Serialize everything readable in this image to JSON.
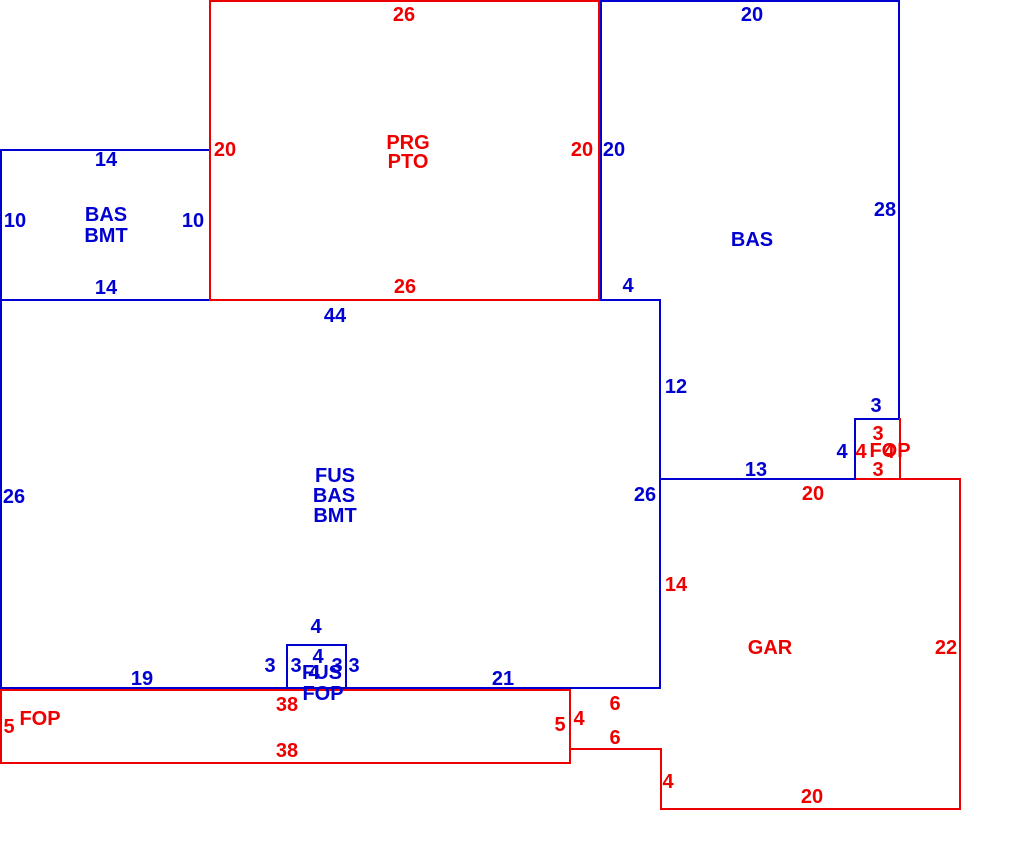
{
  "sketch": {
    "title": "Appraisal floor plan sketch",
    "canvas": {
      "width": 1010,
      "height": 868,
      "background": "#ffffff"
    },
    "colors": {
      "blue": "#0000d0",
      "red": "#ee0000"
    },
    "areas": {
      "basement_left": [
        "BAS",
        "BMT"
      ],
      "patio": [
        "PRG",
        "PTO"
      ],
      "basement_right": [
        "BAS"
      ],
      "main": [
        "FUS",
        "BAS",
        "BMT"
      ],
      "bump": [
        "FUS",
        "FOP"
      ],
      "porch_strip": [
        "FOP"
      ],
      "garage": [
        "GAR"
      ],
      "stoop": [
        "FOP"
      ]
    },
    "labels": [
      {
        "name": "dim-bmt-top-14",
        "text": "14",
        "x": 106,
        "y": 160,
        "color": "blue"
      },
      {
        "name": "dim-bmt-left-10",
        "text": "10",
        "x": 15,
        "y": 221,
        "color": "blue"
      },
      {
        "name": "dim-bmt-right-10",
        "text": "10",
        "x": 193,
        "y": 221,
        "color": "blue"
      },
      {
        "name": "dim-bmt-bottom-14",
        "text": "14",
        "x": 106,
        "y": 288,
        "color": "blue"
      },
      {
        "name": "area-bmt-line1",
        "text": "BAS",
        "x": 106,
        "y": 215,
        "color": "blue"
      },
      {
        "name": "area-bmt-line2",
        "text": "BMT",
        "x": 106,
        "y": 236,
        "color": "blue"
      },
      {
        "name": "dim-prg-top-26",
        "text": "26",
        "x": 404,
        "y": 15,
        "color": "red"
      },
      {
        "name": "dim-prg-left-20",
        "text": "20",
        "x": 225,
        "y": 150,
        "color": "red"
      },
      {
        "name": "area-prg-line1",
        "text": "PRG",
        "x": 408,
        "y": 143,
        "color": "red"
      },
      {
        "name": "area-prg-line2",
        "text": "PTO",
        "x": 408,
        "y": 162,
        "color": "red"
      },
      {
        "name": "dim-prg-right-20",
        "text": "20",
        "x": 582,
        "y": 150,
        "color": "red"
      },
      {
        "name": "dim-prg-bottom-26",
        "text": "26",
        "x": 405,
        "y": 287,
        "color": "red"
      },
      {
        "name": "dim-bas-top-20",
        "text": "20",
        "x": 752,
        "y": 15,
        "color": "blue"
      },
      {
        "name": "dim-bas-left-20",
        "text": "20",
        "x": 614,
        "y": 150,
        "color": "blue"
      },
      {
        "name": "dim-bas-right-28",
        "text": "28",
        "x": 885,
        "y": 210,
        "color": "blue"
      },
      {
        "name": "area-bas-right",
        "text": "BAS",
        "x": 752,
        "y": 240,
        "color": "blue"
      },
      {
        "name": "dim-bas-step-4",
        "text": "4",
        "x": 628,
        "y": 286,
        "color": "blue"
      },
      {
        "name": "dim-bas-side-12",
        "text": "12",
        "x": 676,
        "y": 387,
        "color": "blue"
      },
      {
        "name": "dim-bas-bottom-13",
        "text": "13",
        "x": 756,
        "y": 470,
        "color": "blue"
      },
      {
        "name": "dim-bas-notch-3",
        "text": "3",
        "x": 876,
        "y": 406,
        "color": "blue"
      },
      {
        "name": "dim-bas-notch-4",
        "text": "4",
        "x": 842,
        "y": 452,
        "color": "blue"
      },
      {
        "name": "dim-stoop-top-3",
        "text": "3",
        "x": 878,
        "y": 434,
        "color": "red"
      },
      {
        "name": "dim-stoop-left-4",
        "text": "4",
        "x": 861,
        "y": 452,
        "color": "red"
      },
      {
        "name": "area-stoop-fop",
        "text": "FOP",
        "x": 890,
        "y": 451,
        "color": "red"
      },
      {
        "name": "dim-stoop-right-4",
        "text": "4",
        "x": 889,
        "y": 452,
        "color": "red"
      },
      {
        "name": "dim-stoop-bottom-3",
        "text": "3",
        "x": 878,
        "y": 470,
        "color": "red"
      },
      {
        "name": "dim-fus-top-44",
        "text": "44",
        "x": 335,
        "y": 316,
        "color": "blue"
      },
      {
        "name": "dim-fus-left-26",
        "text": "26",
        "x": 14,
        "y": 497,
        "color": "blue"
      },
      {
        "name": "dim-fus-right-26",
        "text": "26",
        "x": 645,
        "y": 495,
        "color": "blue"
      },
      {
        "name": "area-fus-line1",
        "text": "FUS",
        "x": 335,
        "y": 476,
        "color": "blue"
      },
      {
        "name": "area-fus-line2",
        "text": "BAS",
        "x": 334,
        "y": 496,
        "color": "blue"
      },
      {
        "name": "area-fus-line3",
        "text": "BMT",
        "x": 335,
        "y": 516,
        "color": "blue"
      },
      {
        "name": "dim-fus-bottom-19",
        "text": "19",
        "x": 142,
        "y": 679,
        "color": "blue"
      },
      {
        "name": "dim-fus-bottom-21",
        "text": "21",
        "x": 503,
        "y": 679,
        "color": "blue"
      },
      {
        "name": "dim-bump-top-out-4",
        "text": "4",
        "x": 316,
        "y": 627,
        "color": "blue"
      },
      {
        "name": "dim-bump-top-in-4",
        "text": "4",
        "x": 318,
        "y": 657,
        "color": "blue"
      },
      {
        "name": "dim-bump-left-out-3",
        "text": "3",
        "x": 270,
        "y": 666,
        "color": "blue"
      },
      {
        "name": "dim-bump-left-in-3",
        "text": "3",
        "x": 296,
        "y": 666,
        "color": "blue"
      },
      {
        "name": "dim-bump-right-in-3",
        "text": "3",
        "x": 337,
        "y": 666,
        "color": "blue"
      },
      {
        "name": "dim-bump-right-out-3",
        "text": "3",
        "x": 354,
        "y": 666,
        "color": "blue"
      },
      {
        "name": "dim-bump-bottom-4",
        "text": "4",
        "x": 314,
        "y": 673,
        "color": "blue"
      },
      {
        "name": "area-bump-line1",
        "text": "FUS",
        "x": 322,
        "y": 673,
        "color": "blue"
      },
      {
        "name": "area-bump-line2",
        "text": "FOP",
        "x": 323,
        "y": 694,
        "color": "blue"
      },
      {
        "name": "dim-gar-top-20",
        "text": "20",
        "x": 813,
        "y": 494,
        "color": "red"
      },
      {
        "name": "dim-gar-left-14",
        "text": "14",
        "x": 676,
        "y": 585,
        "color": "red"
      },
      {
        "name": "area-gar",
        "text": "GAR",
        "x": 770,
        "y": 648,
        "color": "red"
      },
      {
        "name": "dim-gar-right-22",
        "text": "22",
        "x": 946,
        "y": 648,
        "color": "red"
      },
      {
        "name": "dim-gar-bottom-20",
        "text": "20",
        "x": 812,
        "y": 797,
        "color": "red"
      },
      {
        "name": "dim-gar-step-4",
        "text": "4",
        "x": 668,
        "y": 782,
        "color": "red"
      },
      {
        "name": "dim-gar-notch-top-6",
        "text": "6",
        "x": 615,
        "y": 704,
        "color": "red"
      },
      {
        "name": "dim-gar-notch-bot-6",
        "text": "6",
        "x": 615,
        "y": 738,
        "color": "red"
      },
      {
        "name": "dim-gar-notch-side-4",
        "text": "4",
        "x": 579,
        "y": 719,
        "color": "red"
      },
      {
        "name": "area-fop-strip",
        "text": "FOP",
        "x": 40,
        "y": 719,
        "color": "red"
      },
      {
        "name": "dim-fop-left-5",
        "text": "5",
        "x": 9,
        "y": 727,
        "color": "red"
      },
      {
        "name": "dim-fop-top-38",
        "text": "38",
        "x": 287,
        "y": 705,
        "color": "red"
      },
      {
        "name": "dim-fop-bottom-38",
        "text": "38",
        "x": 287,
        "y": 751,
        "color": "red"
      },
      {
        "name": "dim-fop-right-5",
        "text": "5",
        "x": 560,
        "y": 725,
        "color": "red"
      }
    ],
    "lines": [
      {
        "name": "bas-top-edge",
        "x": 600,
        "y": 0,
        "w": 300,
        "h": 2,
        "color": "blue"
      },
      {
        "name": "bas-right-edge",
        "x": 898,
        "y": 0,
        "w": 2,
        "h": 420,
        "color": "blue"
      },
      {
        "name": "bas-notch-top-edge",
        "x": 854,
        "y": 418,
        "w": 46,
        "h": 2,
        "color": "blue"
      },
      {
        "name": "bas-notch-side-edge",
        "x": 854,
        "y": 418,
        "w": 2,
        "h": 62,
        "color": "blue"
      },
      {
        "name": "bas-bottom-13-edge",
        "x": 659,
        "y": 478,
        "w": 197,
        "h": 2,
        "color": "blue"
      },
      {
        "name": "fus-right-edge",
        "x": 659,
        "y": 299,
        "w": 2,
        "h": 390,
        "color": "blue"
      },
      {
        "name": "bas-left-edge",
        "x": 600,
        "y": 0,
        "w": 2,
        "h": 301,
        "color": "blue"
      },
      {
        "name": "fus-top-edge",
        "x": 0,
        "y": 299,
        "w": 661,
        "h": 2,
        "color": "blue"
      },
      {
        "name": "west-edge",
        "x": 0,
        "y": 149,
        "w": 2,
        "h": 540,
        "color": "blue"
      },
      {
        "name": "bmt-top-edge",
        "x": 0,
        "y": 149,
        "w": 211,
        "h": 2,
        "color": "blue"
      },
      {
        "name": "fus-bottom-edge",
        "x": 0,
        "y": 687,
        "w": 661,
        "h": 2,
        "color": "blue"
      },
      {
        "name": "bump-left-edge",
        "x": 286,
        "y": 644,
        "w": 2,
        "h": 45,
        "color": "blue"
      },
      {
        "name": "bump-top-edge",
        "x": 286,
        "y": 644,
        "w": 61,
        "h": 2,
        "color": "blue"
      },
      {
        "name": "bump-right-edge",
        "x": 345,
        "y": 644,
        "w": 2,
        "h": 45,
        "color": "blue"
      },
      {
        "name": "prg-left-edge",
        "x": 209,
        "y": 0,
        "w": 2,
        "h": 301,
        "color": "red"
      },
      {
        "name": "prg-top-edge",
        "x": 209,
        "y": 0,
        "w": 390,
        "h": 2,
        "color": "red"
      },
      {
        "name": "prg-right-edge",
        "x": 598,
        "y": 0,
        "w": 2,
        "h": 301,
        "color": "red"
      },
      {
        "name": "prg-bottom-edge",
        "x": 209,
        "y": 299,
        "w": 390,
        "h": 2,
        "color": "red"
      },
      {
        "name": "fop-strip-top-edge",
        "x": 0,
        "y": 689,
        "w": 571,
        "h": 2,
        "color": "red"
      },
      {
        "name": "fop-strip-left-edge",
        "x": 0,
        "y": 689,
        "w": 2,
        "h": 75,
        "color": "red"
      },
      {
        "name": "fop-strip-bottom-edge",
        "x": 0,
        "y": 762,
        "w": 571,
        "h": 2,
        "color": "red"
      },
      {
        "name": "fop-strip-right-edge",
        "x": 569,
        "y": 689,
        "w": 2,
        "h": 75,
        "color": "red"
      },
      {
        "name": "gar-notch-h-edge",
        "x": 569,
        "y": 748,
        "w": 93,
        "h": 2,
        "color": "red"
      },
      {
        "name": "gar-left-lower-edge",
        "x": 660,
        "y": 748,
        "w": 2,
        "h": 62,
        "color": "red"
      },
      {
        "name": "gar-bottom-edge",
        "x": 660,
        "y": 808,
        "w": 301,
        "h": 2,
        "color": "red"
      },
      {
        "name": "gar-right-edge",
        "x": 959,
        "y": 478,
        "w": 2,
        "h": 332,
        "color": "red"
      },
      {
        "name": "gar-top-edge",
        "x": 856,
        "y": 478,
        "w": 105,
        "h": 2,
        "color": "red"
      },
      {
        "name": "stoop-right-edge",
        "x": 899,
        "y": 418,
        "w": 2,
        "h": 62,
        "color": "red"
      }
    ]
  }
}
